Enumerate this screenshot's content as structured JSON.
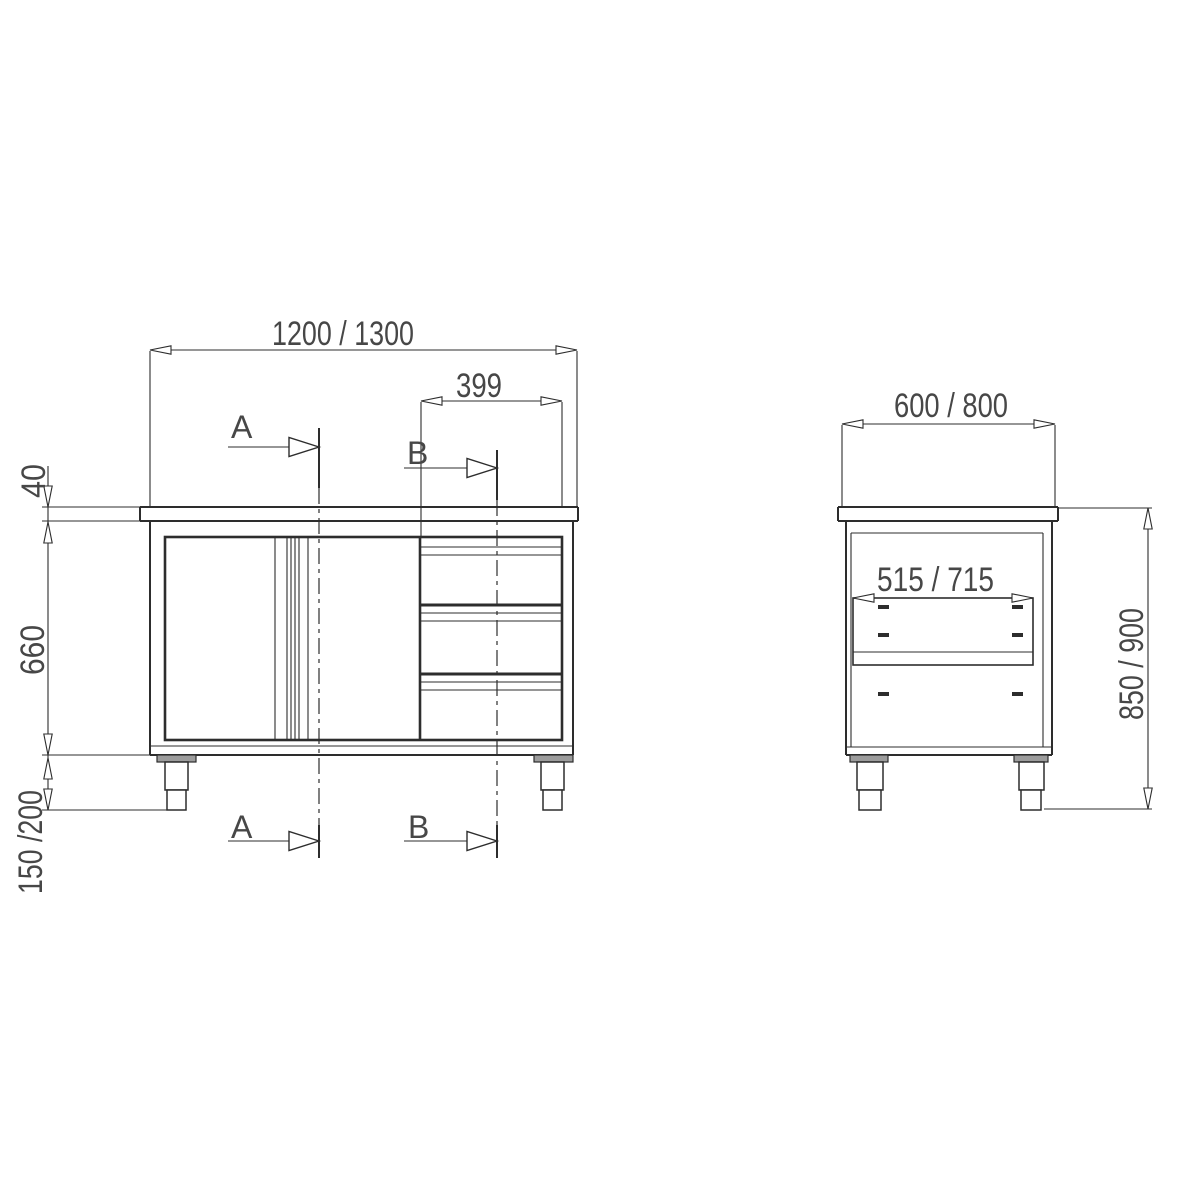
{
  "colors": {
    "line": "#2d2d2d",
    "text": "#474747",
    "leg_flange_fill": "#9c9c9c",
    "background": "#ffffff"
  },
  "front_view": {
    "dim_total_width": "1200 / 1300",
    "dim_drawer_width": "399",
    "dim_worktop_thickness": "40",
    "dim_body_height": "660",
    "dim_leg_height": "150 /200",
    "section_a_label": "A",
    "section_b_label": "B"
  },
  "side_view": {
    "dim_total_depth": "600 / 800",
    "dim_inner_depth": "515 / 715",
    "dim_total_height": "850 / 900"
  }
}
